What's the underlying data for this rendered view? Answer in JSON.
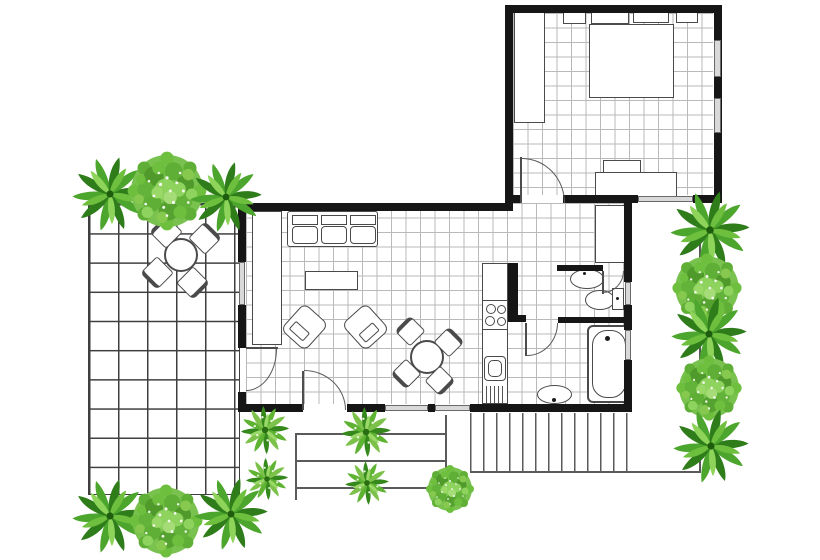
{
  "scene": {
    "type": "floor-plan",
    "width": 820,
    "height": 560,
    "background": "#ffffff"
  },
  "colors": {
    "background": "#ffffff",
    "wall": "#161616",
    "tile_grid": "#b9b9b9",
    "patio_grid": "#3f3f3f",
    "furniture_outline": "#4a4a4a",
    "outdoor_line": "#5a5a5a",
    "window_fill": "#d9d9d9",
    "plant_dark_green": "#2e7d1a",
    "plant_mid_green": "#4ca52c",
    "plant_light_green": "#7cc24a",
    "plant_pale_green": "#9ad868"
  },
  "floor_plan": {
    "rooms": [
      {
        "name": "bedroom",
        "position": "top-right",
        "furniture": [
          "wardrobe",
          "nightstand-left",
          "pillow",
          "pillow",
          "nightstand-right",
          "double-bed",
          "tv",
          "dresser"
        ],
        "windows": 3,
        "doors": 1
      },
      {
        "name": "living-room",
        "position": "center",
        "furniture": [
          "wall-unit",
          "sofa-3-seat",
          "coffee-table",
          "armchair",
          "armchair",
          "round-dining-table",
          "dining-chair",
          "dining-chair",
          "dining-chair",
          "dining-chair"
        ],
        "windows": 4,
        "doors": 2
      },
      {
        "name": "kitchen",
        "position": "center-right",
        "furniture": [
          "counter",
          "stove-4-burner",
          "kitchen-sink",
          "appliance-vent"
        ]
      },
      {
        "name": "hallway",
        "position": "right",
        "furniture": [
          "hall-closet"
        ]
      },
      {
        "name": "toilet-room",
        "position": "right",
        "furniture": [
          "wash-basin",
          "toilet"
        ],
        "windows": 1,
        "doors": 1
      },
      {
        "name": "bath-room",
        "position": "bottom-right",
        "furniture": [
          "bathtub",
          "pedestal-sink"
        ],
        "windows": 1,
        "doors": 1
      },
      {
        "name": "patio",
        "position": "left",
        "furniture": [
          "round-patio-table",
          "patio-chair",
          "patio-chair",
          "patio-chair",
          "patio-chair"
        ]
      },
      {
        "name": "entry-steps",
        "position": "bottom-center",
        "steps": 3
      },
      {
        "name": "deck",
        "position": "bottom-right",
        "style": "vertical-planks"
      }
    ]
  },
  "plants": [
    {
      "type": "palm",
      "cx": 110,
      "cy": 194,
      "r": 40
    },
    {
      "type": "tree",
      "cx": 167,
      "cy": 191,
      "r": 41
    },
    {
      "type": "palm",
      "cx": 226,
      "cy": 197,
      "r": 38
    },
    {
      "type": "palm",
      "cx": 710,
      "cy": 230,
      "r": 42
    },
    {
      "type": "tree",
      "cx": 707,
      "cy": 288,
      "r": 36
    },
    {
      "type": "palm",
      "cx": 709,
      "cy": 334,
      "r": 40
    },
    {
      "type": "tree",
      "cx": 709,
      "cy": 388,
      "r": 34
    },
    {
      "type": "palm",
      "cx": 711,
      "cy": 446,
      "r": 40
    },
    {
      "type": "palm",
      "cx": 110,
      "cy": 516,
      "r": 40
    },
    {
      "type": "tree",
      "cx": 166,
      "cy": 521,
      "r": 38
    },
    {
      "type": "palm",
      "cx": 231,
      "cy": 514,
      "r": 39
    },
    {
      "type": "shrub",
      "cx": 265,
      "cy": 430,
      "r": 32
    },
    {
      "type": "shrub",
      "cx": 267,
      "cy": 479,
      "r": 28
    },
    {
      "type": "shrub",
      "cx": 366,
      "cy": 432,
      "r": 33
    },
    {
      "type": "shrub",
      "cx": 367,
      "cy": 483,
      "r": 29
    },
    {
      "type": "tree",
      "cx": 450,
      "cy": 489,
      "r": 25
    }
  ]
}
